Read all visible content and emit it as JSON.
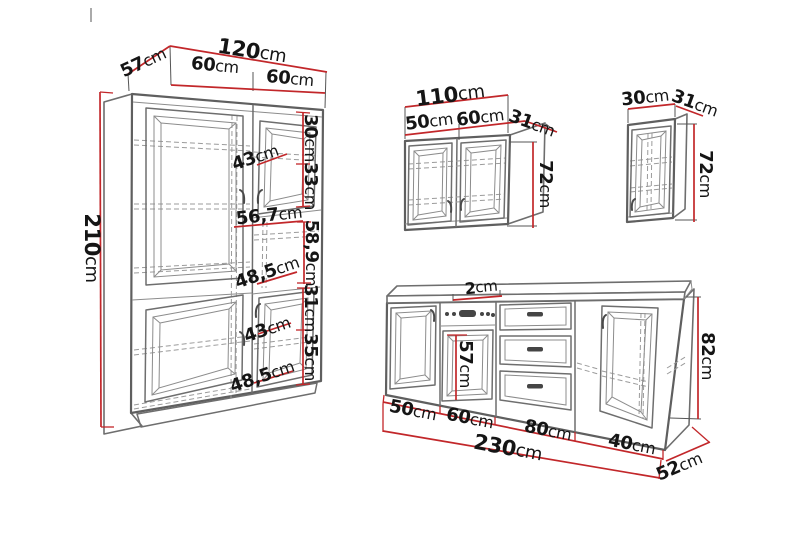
{
  "unit": "cm",
  "colors": {
    "dimension_red": "#c2272a",
    "drawing_gray": "#5f5f5f",
    "text": "#151515",
    "background": "#ffffff"
  },
  "tall_cabinet": {
    "total_width": "120",
    "depth": "57",
    "left_section_width": "60",
    "right_section_width": "60",
    "height": "210",
    "upper_door_part1": "30",
    "upper_door_part2": "33",
    "upper_inner_width": "43",
    "niche_width": "56,7",
    "niche_height": "58,9",
    "upper_inner_width2": "48,5",
    "lower_door_part1": "31",
    "lower_door_part2": "35",
    "lower_inner_width": "43",
    "lower_inner_width2": "48,5"
  },
  "wall_cabinet_wide": {
    "total_width": "110",
    "left_door_width": "50",
    "right_door_width": "60",
    "depth": "31",
    "height": "72"
  },
  "wall_cabinet_narrow": {
    "width": "30",
    "depth": "31",
    "height": "72"
  },
  "base_unit": {
    "worktop_thickness": "2",
    "oven_height": "57",
    "height": "82",
    "section1_width": "50",
    "section2_width": "60",
    "section3_width": "80",
    "section4_width": "40",
    "total_width": "230",
    "depth": "52"
  }
}
